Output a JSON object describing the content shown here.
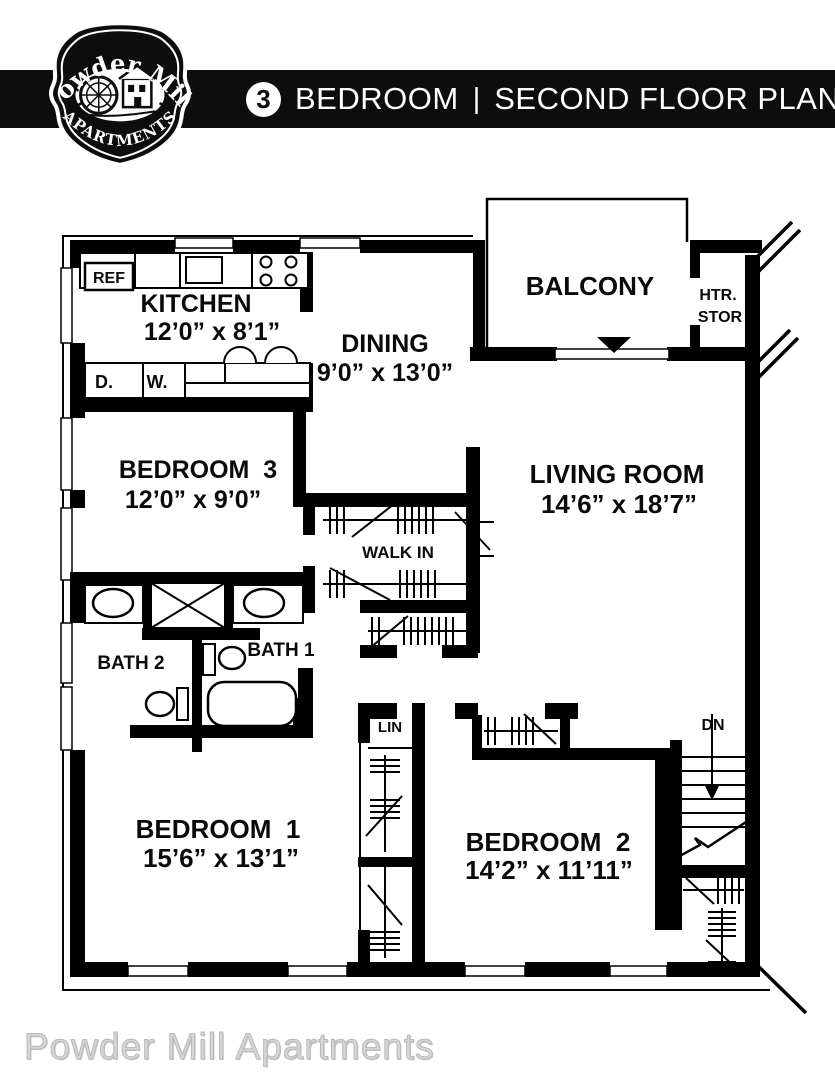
{
  "header": {
    "unit_count": "3",
    "title_left": "BEDROOM",
    "separator": "|",
    "title_right": "SECOND FLOOR PLAN"
  },
  "badge": {
    "line1": "Powder Mill",
    "line2": "APARTMENTS"
  },
  "rooms": {
    "kitchen": {
      "name": "KITCHEN",
      "dims": "12’0” x 8’1”"
    },
    "dining": {
      "name": "DINING",
      "dims": "9’0” x 13’0”"
    },
    "balcony": {
      "name": "BALCONY"
    },
    "heater_storage": {
      "line1": "HTR.",
      "line2": "STOR"
    },
    "bedroom3": {
      "name": "BEDROOM  3",
      "dims": "12’0” x 9’0”"
    },
    "living_room": {
      "name": "LIVING ROOM",
      "dims": "14’6” x 18’7”"
    },
    "walk_in": {
      "name": "WALK IN"
    },
    "bath1": {
      "name": "BATH 1"
    },
    "bath2": {
      "name": "BATH 2"
    },
    "bedroom1": {
      "name": "BEDROOM  1",
      "dims": "15’6” x 13’1”"
    },
    "bedroom2": {
      "name": "BEDROOM  2",
      "dims": "14’2” x 11’11”"
    }
  },
  "labels": {
    "refrigerator": "REF",
    "dryer": "D.",
    "washer": "W.",
    "linen": "LIN",
    "stairs_down": "DN"
  },
  "footer": {
    "text": "Powder Mill Apartments"
  },
  "colors": {
    "header_bg": "#0d0d0d",
    "line": "#000000",
    "footer_text": "#d6d6d6"
  }
}
